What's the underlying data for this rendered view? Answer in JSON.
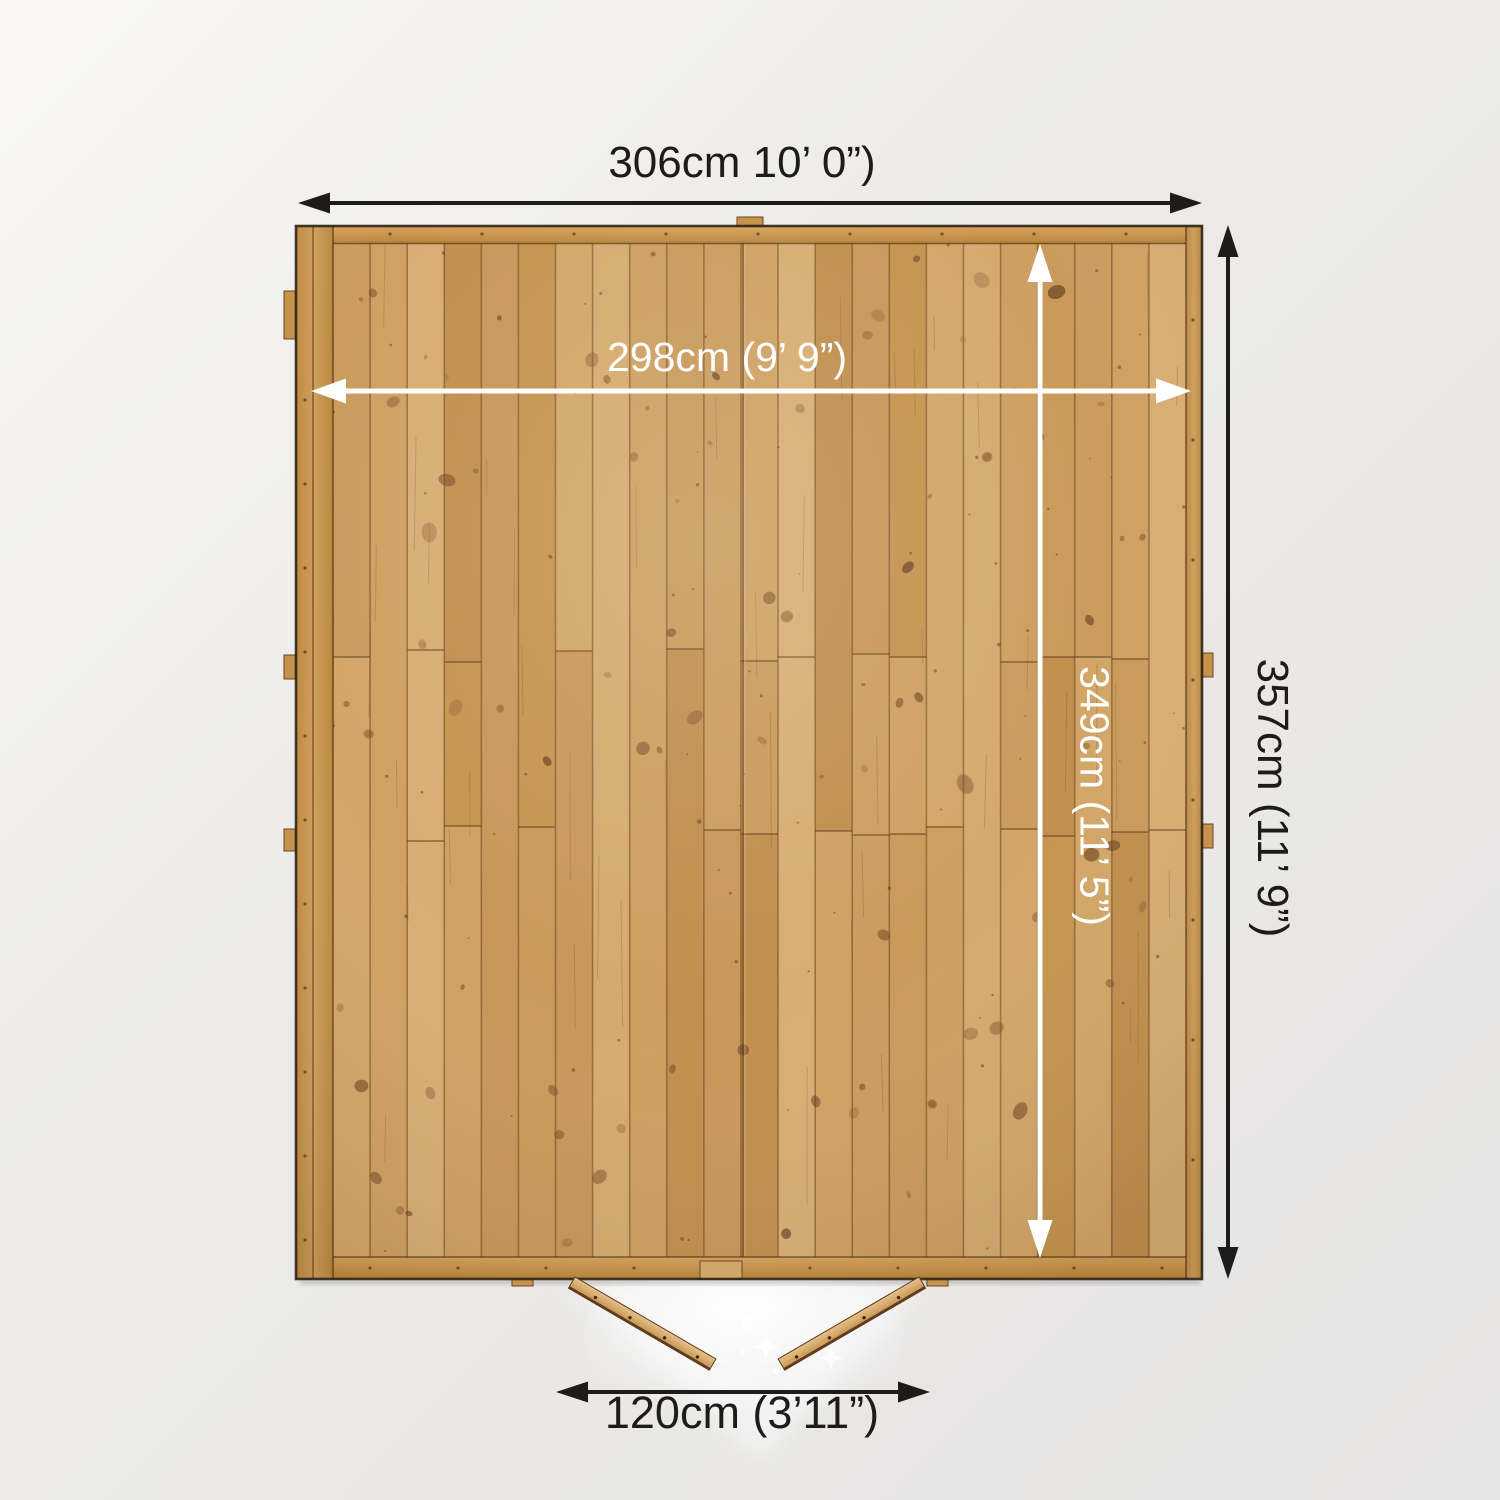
{
  "title": "Shed floor plan dimension diagram (top-down view)",
  "labels": {
    "external_width": "306cm 10’ 0”)",
    "internal_width": "298cm (9’ 9”)",
    "internal_depth": "349cm (11’ 5”)",
    "external_depth": "357cm (11’ 9”)",
    "door_width": "120cm (3’11”)"
  },
  "colors": {
    "background": "#ebeae8",
    "wood_base": "#cda167",
    "wood_frame": "#c9944c",
    "wood_dark_line": "#5e3c1d",
    "arrow_black": "#1d1c1a",
    "arrow_white": "#ffffff"
  }
}
